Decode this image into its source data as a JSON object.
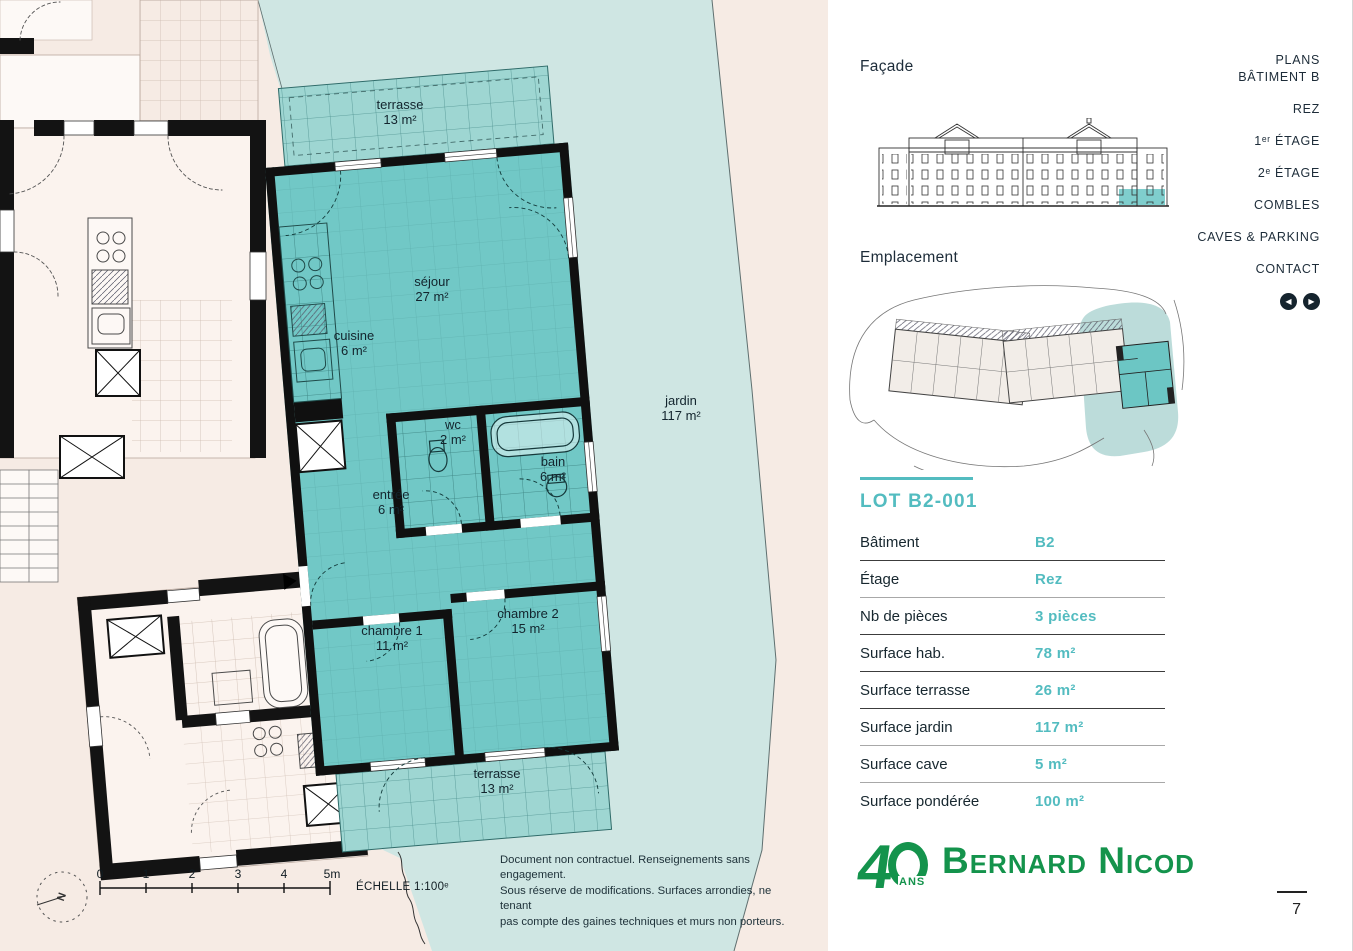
{
  "colors": {
    "accent_teal": "#53bcc0",
    "dark_navy": "#1d2c39",
    "logo_green": "#14934c",
    "apartment_teal": "#71c8c6",
    "jardin_blue": "#cfe6e3",
    "plan_pink": "#f6ebe4"
  },
  "nav": {
    "items": [
      {
        "label": "PLANS",
        "label2": "BÂTIMENT B"
      },
      {
        "label": "REZ"
      },
      {
        "label": "1ᵉʳ ÉTAGE"
      },
      {
        "label": "2ᵉ ÉTAGE"
      },
      {
        "label": "COMBLES"
      },
      {
        "label": "CAVES & PARKING"
      },
      {
        "label": "CONTACT"
      }
    ]
  },
  "sidebar": {
    "facade_label": "Façade",
    "emplacement_label": "Emplacement",
    "lot_title": "LOT B2-001",
    "table": {
      "rows": [
        {
          "label": "Bâtiment",
          "value": "B2"
        },
        {
          "label": "Étage",
          "value": "Rez"
        },
        {
          "label": "Nb de pièces",
          "value": "3 pièces"
        },
        {
          "label": "Surface hab.",
          "value": "78 m²"
        },
        {
          "label": "Surface terrasse",
          "value": "26 m²"
        },
        {
          "label": "Surface jardin",
          "value": "117 m²"
        },
        {
          "label": "Surface cave",
          "value": "5 m²"
        },
        {
          "label": "Surface pondérée",
          "value": "100 m²"
        }
      ]
    },
    "logo": {
      "number": "4",
      "years": "ANS",
      "name": "Bernard Nicod"
    }
  },
  "plan": {
    "rooms": [
      {
        "name": "terrasse",
        "area": "13 m²"
      },
      {
        "name": "séjour",
        "area": "27 m²"
      },
      {
        "name": "cuisine",
        "area": "6 m²"
      },
      {
        "name": "wc",
        "area": "2 m²"
      },
      {
        "name": "bain",
        "area": "6 m²"
      },
      {
        "name": "entrée",
        "area": "6 m²"
      },
      {
        "name": "chambre 1",
        "area": "11 m²"
      },
      {
        "name": "chambre 2",
        "area": "15 m²"
      },
      {
        "name": "jardin",
        "area": "117 m²"
      },
      {
        "name": "terrasse",
        "area": "13 m²"
      }
    ],
    "disclaimer": [
      "Document non contractuel. Renseignements sans engagement.",
      "Sous réserve de modifications. Surfaces arrondies, ne tenant",
      "pas compte des gaines techniques et murs non porteurs."
    ],
    "scale": {
      "ticks": [
        "0",
        "1",
        "2",
        "3",
        "4",
        "5m"
      ],
      "label": "ÉCHELLE 1:100ᵉ"
    },
    "north_label": "N"
  },
  "footer": {
    "page_number": "7"
  }
}
